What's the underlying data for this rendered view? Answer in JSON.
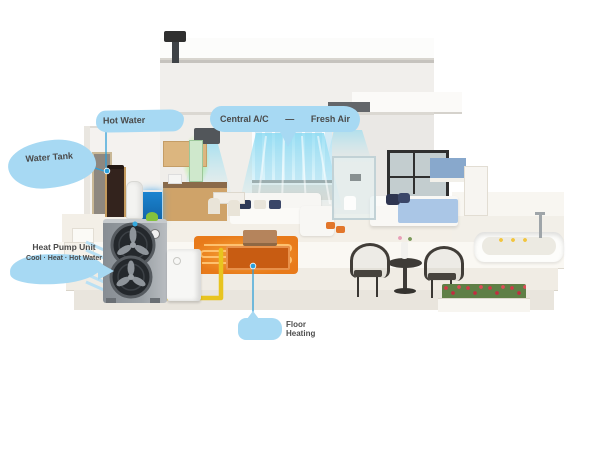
{
  "callouts": {
    "hot_water": {
      "label": "Hot Water"
    },
    "water_tank": {
      "label": "Water Tank"
    },
    "comfort": {
      "left_label": "Central A/C",
      "separator": "—",
      "right_label": "Fresh Air"
    },
    "heat_pump": {
      "line1": "Heat Pump Unit",
      "line2": "Cool · Heat · Hot Water"
    },
    "floor_heating": {
      "line1": "Floor",
      "line2": "Heating"
    }
  },
  "colors": {
    "callout_blue": "#a7d9f3",
    "leader_blue": "#2aa0dc",
    "air_stream_cyan": "#86d9f2",
    "fresh_air_green": "#8ef060",
    "floor_heat_orange": "#e87a1a",
    "pipe_yellow": "#e8c41f"
  }
}
